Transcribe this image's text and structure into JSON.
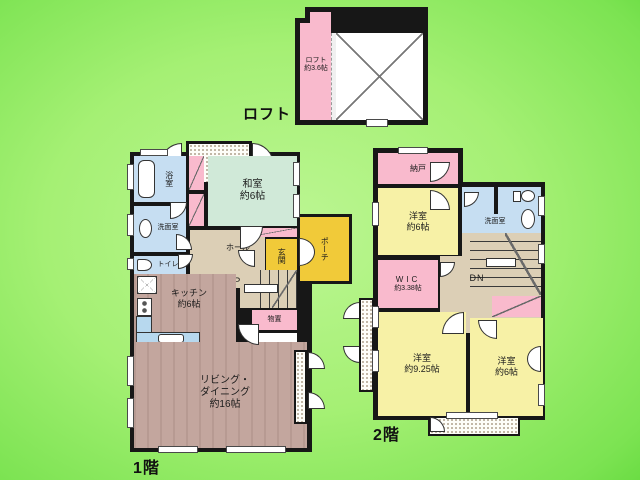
{
  "captions": {
    "floor1": "1階",
    "floor2": "2階",
    "loft": "ロフト"
  },
  "loft": {
    "room": "ロフト",
    "size": "約3.6帖"
  },
  "floor1": {
    "bathroom": "浴室",
    "washroom": "洗面室",
    "toilet": "トイレ",
    "japanese_room": "和室",
    "japanese_room_size": "約6帖",
    "hall": "ホール",
    "entrance": "玄関",
    "porch": "ポーチ",
    "stairs_up": "UP",
    "storage": "物置",
    "kitchen": "キッチン",
    "kitchen_size": "約6帖",
    "living1": "リビング・",
    "living2": "ダイニング",
    "living_size": "約16帖"
  },
  "floor2": {
    "storeroom": "納戸",
    "west_room_a": "洋室",
    "west_room_a_size": "約6帖",
    "washroom": "洗面室",
    "stairs_down": "DN",
    "wic": "WIC",
    "wic_size": "約3.38帖",
    "west_room_b": "洋室",
    "west_room_b_size": "約9.25帖",
    "west_room_c": "洋室",
    "west_room_c_size": "約6帖"
  },
  "colors": {
    "background_light": "#bcf693",
    "background_dark": "#3fcb1e",
    "wall": "#171717",
    "closet_pink": "#f9bacd",
    "water_blue": "#c6def2",
    "tatami_green": "#d0e9d8",
    "entrance_yellow": "#f1ca39",
    "room_yellow": "#f7f1a6",
    "hall_beige": "#dccfb6",
    "floor_wood": "#c3a69e",
    "counter_blue": "#b7d8ee"
  }
}
